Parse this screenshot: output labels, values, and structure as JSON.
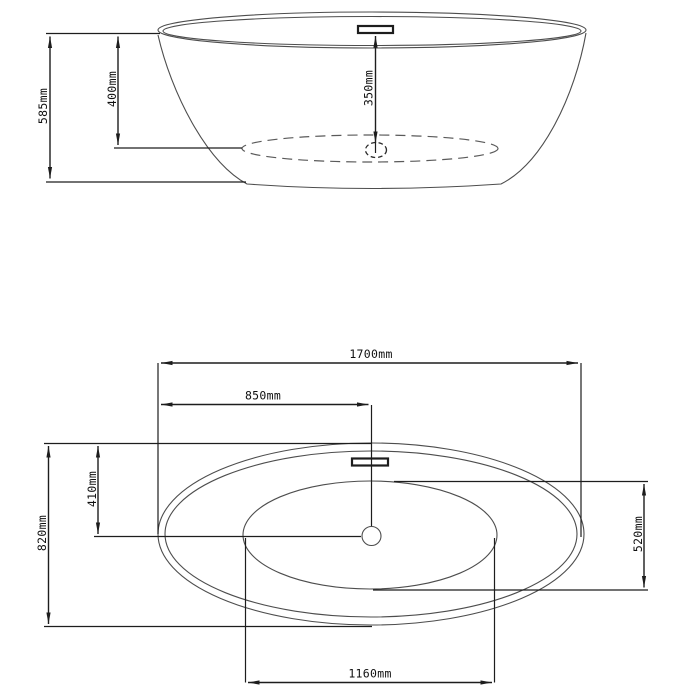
{
  "colors": {
    "background": "#ffffff",
    "dimension_line": "#1d1d1d",
    "tub_outline": "#4d4d4d"
  },
  "drawing": {
    "views": {
      "side_elevation": {
        "dims": {
          "overall_height": "585mm",
          "rim_to_basin_floor": "400mm",
          "overflow_to_drain": "350mm"
        }
      },
      "plan": {
        "dims": {
          "overall_length": "1700mm",
          "drain_centre_from_left": "850mm",
          "overall_width": "820mm",
          "centreline_from_top": "410mm",
          "basin_width": "520mm",
          "basin_length": "1160mm"
        }
      }
    },
    "values_mm": {
      "overall_height": 585,
      "rim_to_basin_floor": 400,
      "overflow_to_drain": 350,
      "overall_length": 1700,
      "drain_centre_from_left": 850,
      "overall_width": 820,
      "centreline_from_top": 410,
      "basin_width": 520,
      "basin_length": 1160
    }
  }
}
